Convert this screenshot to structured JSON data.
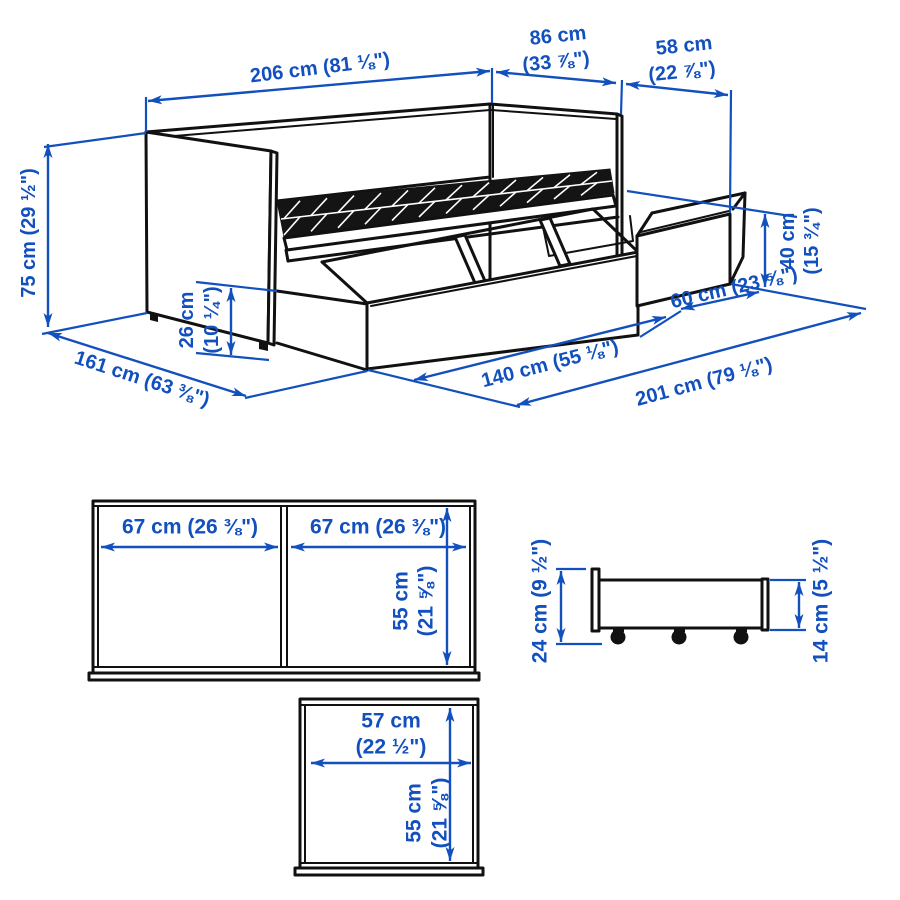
{
  "accent_color": "#1250be",
  "line_color": "#111111",
  "perspective_view": {
    "dims": {
      "length": "206 cm (81 ⅛\")",
      "depth_top": {
        "l1": "86 cm",
        "l2": "(33 ⅞\")"
      },
      "drawer_ext": {
        "l1": "58 cm",
        "l2": "(22 ⅞\")"
      },
      "height": "75 cm (29 ½\")",
      "depth_open": "161 cm (63 ⅜\")",
      "clearance": {
        "l1": "26 cm",
        "l2": "(10 ¼\")"
      },
      "drawer_height": {
        "l1": "40 cm",
        "l2": "(15 ¾\")"
      },
      "front_drawer_length": "140 cm (55 ⅛\")",
      "side_drawer_length": "60 cm (23 ⅝\")",
      "total_length": "201 cm (79 ⅛\")"
    }
  },
  "front_view": {
    "left_bay_width": "67 cm (26 ⅜\")",
    "right_bay_width": "67 cm (26 ⅜\")",
    "height": {
      "l1": "55 cm",
      "l2": "(21 ⅝\")"
    }
  },
  "side_view": {
    "total_height": "24 cm (9 ½\")",
    "body_height": "14 cm (5 ½\")"
  },
  "top_view": {
    "width": {
      "l1": "57 cm",
      "l2": "(22 ½\")"
    },
    "depth": {
      "l1": "55 cm",
      "l2": "(21 ⅝\")"
    }
  }
}
